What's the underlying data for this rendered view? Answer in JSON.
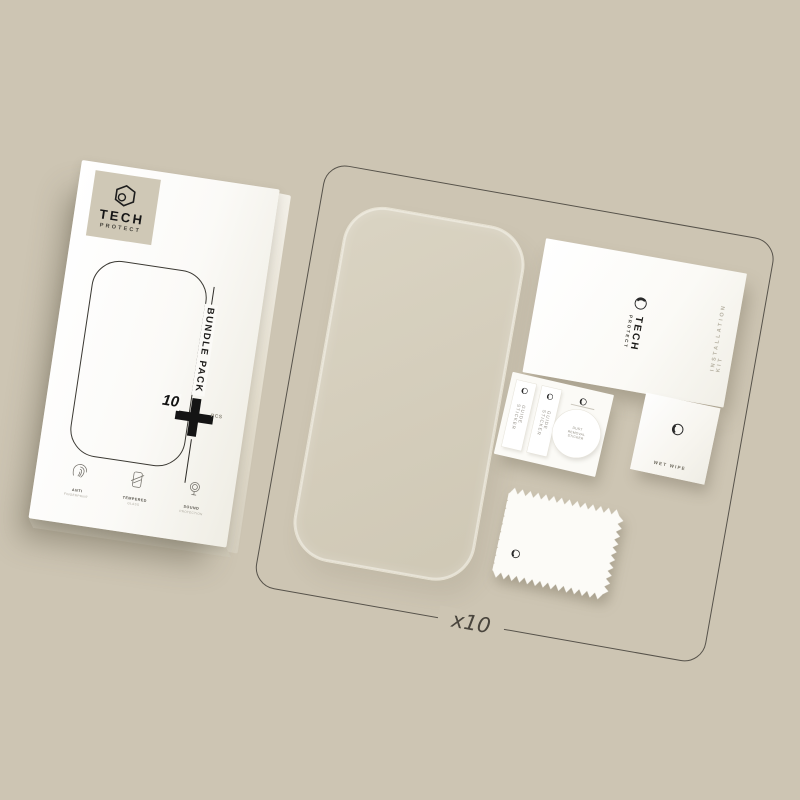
{
  "scene": {
    "quantity": "x10"
  },
  "colors": {
    "background": "#cdc5b3",
    "panel_outline": "#56524a",
    "ink": "#161616",
    "glass_tint": "#d4cdbb",
    "logo_plate": "#cfc8b6"
  },
  "box": {
    "brand_name": "TECH",
    "brand_sub": "PROTECT",
    "bundle_label": "BUNDLE PACK",
    "qty_number": "10",
    "qty_unit": "PCS",
    "features": [
      {
        "icon": "fingerprint-icon",
        "line1": "ANTI",
        "line2": "FINGERPRINT"
      },
      {
        "icon": "tempered-glass-icon",
        "line1": "TEMPERED",
        "line2": "GLASS"
      },
      {
        "icon": "speaker-protection-icon",
        "line1": "SOUND",
        "line2": "PROTECTION"
      }
    ]
  },
  "kit": {
    "card": {
      "brand_name": "TECH",
      "brand_sub": "PROTECT",
      "side_label": "INSTALLATION KIT"
    },
    "stickers": {
      "strips": [
        "GUIDE STICKER",
        "GUIDE STICKER"
      ],
      "round_label": "DUST REMOVAL STICKER"
    },
    "wet_wipe_label": "WET WIPE"
  }
}
